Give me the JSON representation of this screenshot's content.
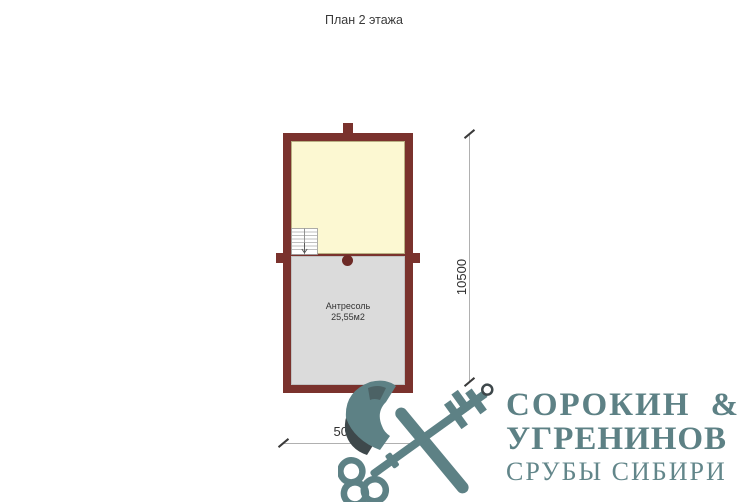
{
  "title": "План 2 этажа",
  "plan": {
    "room_lower": {
      "label": "Антресоль",
      "area": "25,55м2"
    },
    "dimensions": {
      "height_label": "10500",
      "width_label": "5000"
    },
    "colors": {
      "wall": "#7a322d",
      "room_upper_fill": "#fcf8d2",
      "room_lower_fill": "#dbdbdb",
      "dimension_line": "#b0b0b0"
    },
    "icons": [
      "staircase-icon"
    ]
  },
  "logo": {
    "line1": "СОРОКИН  &",
    "line2": "УГРЕНИНОВ",
    "line3": "СРУБЫ СИБИРИ",
    "icon": "crossed-axe-and-key-icon",
    "colors": {
      "main": "#5d8185",
      "accent_dark": "#3e484b"
    }
  }
}
